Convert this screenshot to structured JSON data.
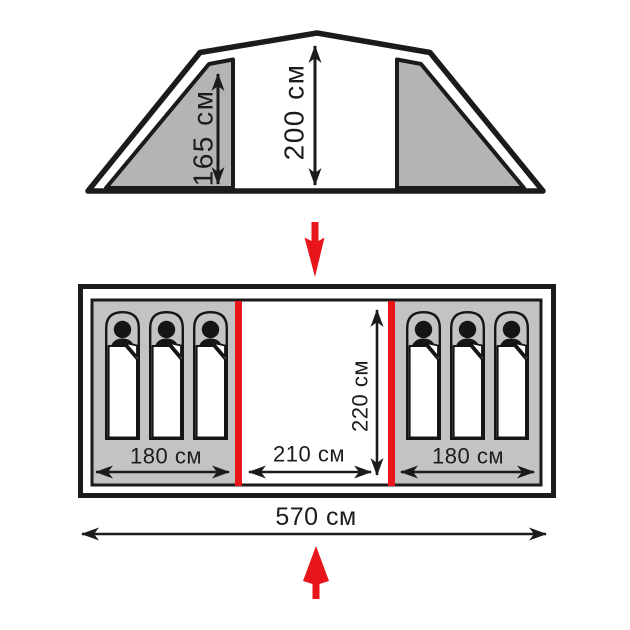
{
  "diagram": {
    "side_view": {
      "inner_height_label": "165 см",
      "center_height_label": "200 см"
    },
    "floor_plan": {
      "left_room_width_label": "180 см",
      "vestibule_width_label": "210 см",
      "right_room_width_label": "180 см",
      "room_depth_label": "220 см",
      "total_length_label": "570 см",
      "sleeper_count_left": 3,
      "sleeper_count_right": 3
    }
  },
  "colors": {
    "red": "#e8151a",
    "panel_gray": "#b4b4b4",
    "floor_gray": "#c3c3c3",
    "bag_gray": "#c3c3c3",
    "line": "#1b1b1b"
  }
}
